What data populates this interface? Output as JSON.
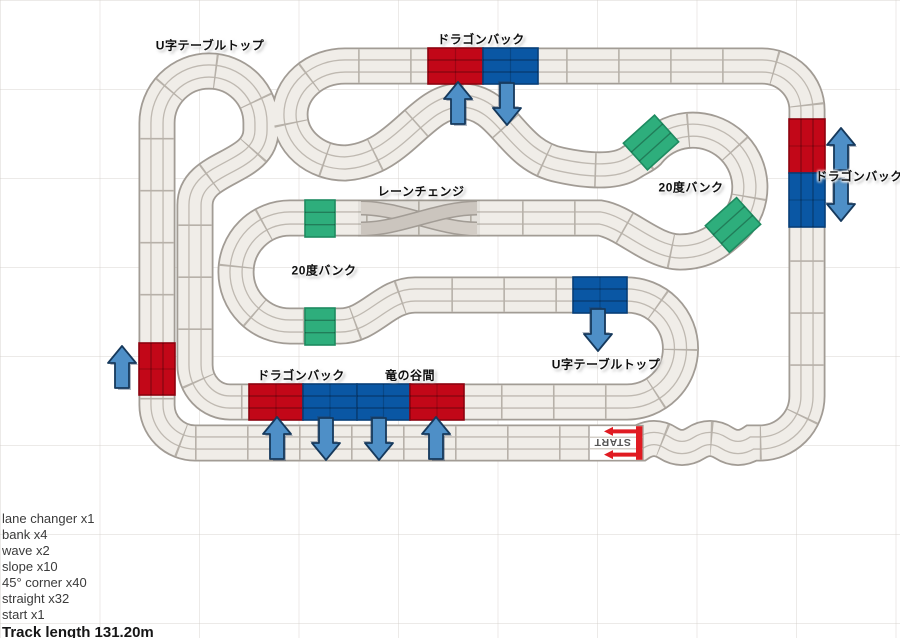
{
  "canvas": {
    "width": 900,
    "height": 638
  },
  "labels": [
    {
      "text": "U字テーブルトップ",
      "x": 210,
      "y": 45
    },
    {
      "text": "ドラゴンバック",
      "x": 481,
      "y": 39
    },
    {
      "text": "ドラゴンバック",
      "x": 859,
      "y": 176
    },
    {
      "text": "20度バンク",
      "x": 691,
      "y": 187
    },
    {
      "text": "レーンチェンジ",
      "x": 421,
      "y": 191
    },
    {
      "text": "20度バンク",
      "x": 324,
      "y": 270
    },
    {
      "text": "ドラゴンバック",
      "x": 301,
      "y": 375
    },
    {
      "text": "竜の谷間",
      "x": 410,
      "y": 375
    },
    {
      "text": "U字テーブルトップ",
      "x": 606,
      "y": 364
    }
  ],
  "parts_list": [
    "lane changer x1",
    "bank x4",
    "wave x2",
    "slope x10",
    "45° corner x40",
    "straight x32",
    "start x1"
  ],
  "track_length_label": "Track length 131.20m",
  "start_block": {
    "label": "START",
    "x": 589,
    "y": 425.5,
    "w": 54,
    "h": 35,
    "arrow_direction": "left"
  },
  "sections": [
    {
      "kind": "slope",
      "color": "red",
      "x": 428,
      "y": 48,
      "w": 55,
      "h": 36,
      "rot": 0,
      "o": "h"
    },
    {
      "kind": "slope",
      "color": "blue",
      "x": 483,
      "y": 48,
      "w": 55,
      "h": 36,
      "rot": 0,
      "o": "h"
    },
    {
      "kind": "slope",
      "color": "red",
      "x": 789,
      "y": 119,
      "w": 36,
      "h": 54,
      "rot": 0,
      "o": "v"
    },
    {
      "kind": "slope",
      "color": "blue",
      "x": 789,
      "y": 173,
      "w": 36,
      "h": 54,
      "rot": 0,
      "o": "v"
    },
    {
      "kind": "slope",
      "color": "red",
      "x": 139,
      "y": 343,
      "w": 36,
      "h": 52,
      "rot": 0,
      "o": "v"
    },
    {
      "kind": "slope",
      "color": "red",
      "x": 249,
      "y": 384,
      "w": 54,
      "h": 36,
      "rot": 0,
      "o": "h"
    },
    {
      "kind": "slope",
      "color": "blue",
      "x": 303,
      "y": 384,
      "w": 54,
      "h": 36,
      "rot": 0,
      "o": "h"
    },
    {
      "kind": "slope",
      "color": "blue",
      "x": 357,
      "y": 384,
      "w": 53,
      "h": 36,
      "rot": 0,
      "o": "h"
    },
    {
      "kind": "slope",
      "color": "red",
      "x": 410,
      "y": 384,
      "w": 54,
      "h": 36,
      "rot": 0,
      "o": "h"
    },
    {
      "kind": "slope",
      "color": "blue",
      "x": 573,
      "y": 277,
      "w": 54,
      "h": 36,
      "rot": 0,
      "o": "h"
    },
    {
      "kind": "bank",
      "color": "green",
      "x": 305,
      "y": 200,
      "w": 30,
      "h": 37,
      "rot": 0,
      "o": "h"
    },
    {
      "kind": "bank",
      "color": "green",
      "x": 305,
      "y": 308,
      "w": 30,
      "h": 37,
      "rot": 0,
      "o": "h"
    },
    {
      "kind": "bank",
      "color": "green",
      "x": 630,
      "y": 124.5,
      "w": 42,
      "h": 36,
      "rot": -42,
      "o": "h"
    },
    {
      "kind": "bank",
      "color": "green",
      "x": 712,
      "y": 207,
      "w": 42,
      "h": 36,
      "rot": -42,
      "o": "h"
    }
  ],
  "arrows": [
    {
      "dir": "up",
      "x": 458,
      "y": 103
    },
    {
      "dir": "down",
      "x": 507,
      "y": 104
    },
    {
      "dir": "up",
      "x": 841,
      "y": 149
    },
    {
      "dir": "down",
      "x": 841,
      "y": 200
    },
    {
      "dir": "up",
      "x": 122,
      "y": 367
    },
    {
      "dir": "up",
      "x": 277,
      "y": 438
    },
    {
      "dir": "down",
      "x": 326,
      "y": 439
    },
    {
      "dir": "down",
      "x": 379,
      "y": 439
    },
    {
      "dir": "up",
      "x": 436,
      "y": 438
    },
    {
      "dir": "down",
      "x": 598,
      "y": 330
    }
  ],
  "colors": {
    "track_fill": "#F0EDE8",
    "track_border": "#A29C95",
    "lane_line": "#BFB9B1",
    "joint_line": "#B7B1A9",
    "red": "#C20718",
    "red_dark": "#8C030F",
    "blue": "#0A57A4",
    "blue_dark": "#073E77",
    "green": "#2EAE7C",
    "green_dark": "#1E8A60",
    "arrow_fill": "#4E8FC7",
    "arrow_stroke": "#16395C",
    "start_red": "#E01B22"
  }
}
